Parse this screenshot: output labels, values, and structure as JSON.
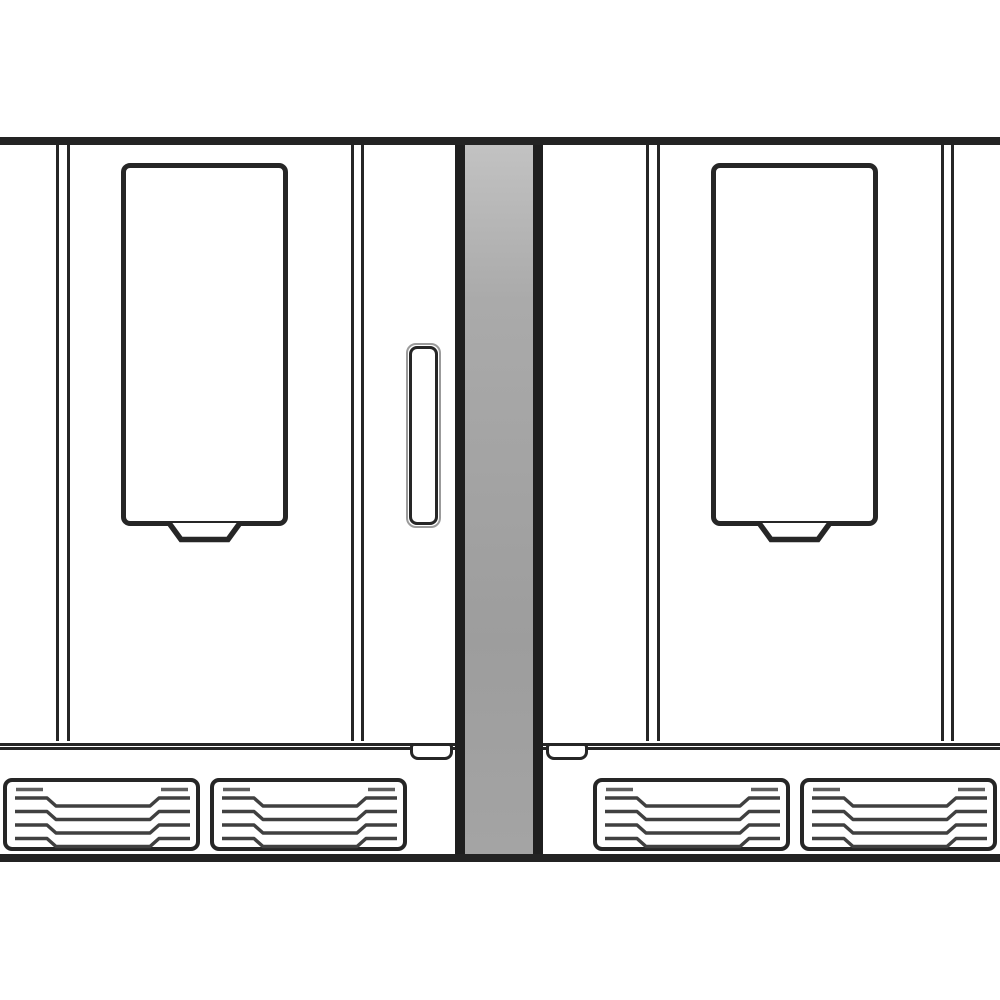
{
  "scene": {
    "type": "line-art-diagram",
    "subject": "Front view of two identical built-in appliances installed side by side in a white wall niche, separated by a gray wall pillar; each has a tall door window with a dispenser spout below it, door seam lines, a plinth with a latch tab, and two louvered ventilation grilles at the base",
    "colors": {
      "background": "#ffffff",
      "line": "#262626",
      "frame_bar": "#232323",
      "wall_edge": "#1f1f1f",
      "wall_gray": "#9d9d9d",
      "wall_gray_light": "#c2c2c2",
      "slat_dark": "#404040",
      "slat_gray": "#5f5f5f",
      "handle_outline_gray": "#9b9b9b"
    }
  },
  "units": [
    {
      "name": "left-appliance",
      "parts": [
        "door-window",
        "dispenser-spout-icon",
        "door-handle",
        "door-seam-line",
        "plinth-latch",
        "vent-grille",
        "vent-grille"
      ]
    },
    {
      "name": "right-appliance",
      "parts": [
        "door-window",
        "dispenser-spout-icon",
        "door-seam-line",
        "plinth-latch",
        "vent-grille",
        "vent-grille"
      ]
    }
  ],
  "wall": {
    "name": "wall-pillar",
    "parts": [
      "wall-pillar-left-edge",
      "wall-pillar-face",
      "wall-pillar-right-edge"
    ]
  },
  "frame": {
    "top": "niche-top-edge",
    "bottom": "floor-edge"
  }
}
